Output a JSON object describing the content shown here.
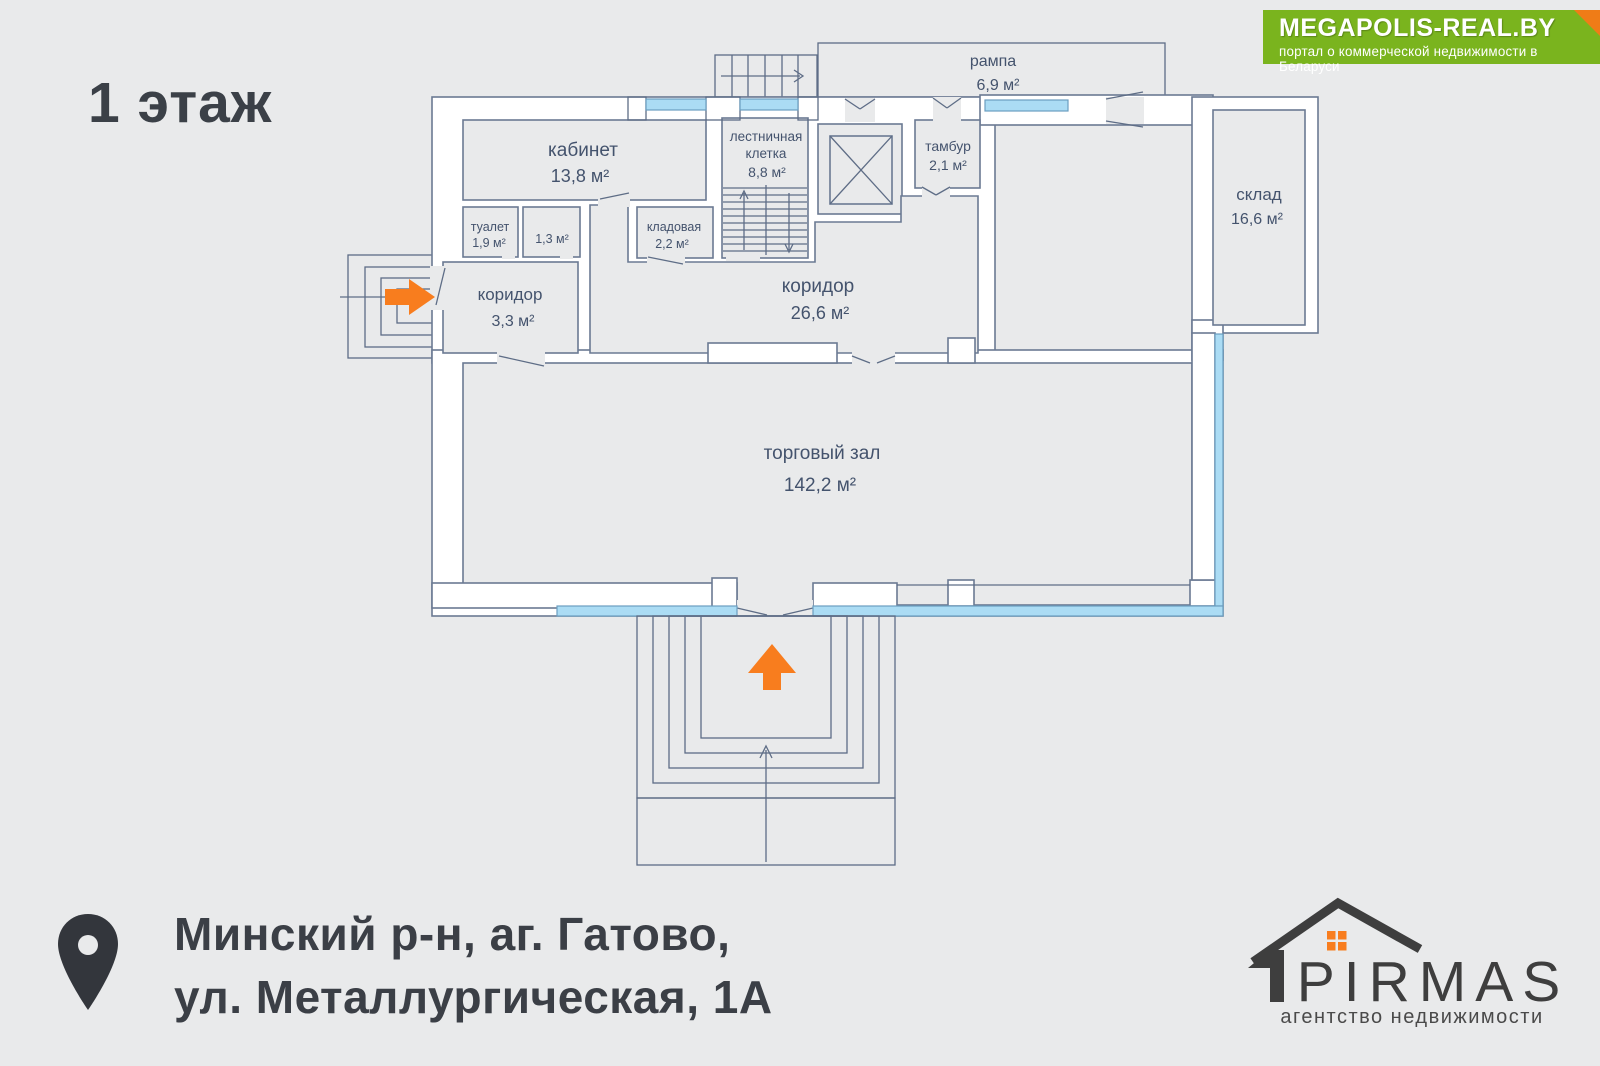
{
  "floor_label": "1 этаж",
  "banner": {
    "title": "MEGAPOLIS-REAL.BY",
    "subtitle": "портал о коммерческой недвижимости в Беларуси",
    "bg_color": "#7ab41e",
    "fold_color": "#ef7c17"
  },
  "address": {
    "line1": "Минский р-н, аг. Гатово,",
    "line2": "ул. Металлургическая, 1А"
  },
  "agency": {
    "name": "PIRMAS",
    "tagline": "агентство недвижимости"
  },
  "plan": {
    "rooms": {
      "kabinet": {
        "name": "кабинет",
        "area": "13,8 м²"
      },
      "tualet": {
        "name": "туалет",
        "area": "1,9 м²"
      },
      "room_1_3": {
        "area": "1,3 м²"
      },
      "kladovaya": {
        "name": "кладовая",
        "area": "2,2 м²"
      },
      "stairwell": {
        "name_line1": "лестничная",
        "name_line2": "клетка",
        "area": "8,8 м²"
      },
      "tambur": {
        "name": "тамбур",
        "area": "2,1 м²"
      },
      "rampa": {
        "name": "рампа",
        "area": "6,9 м²"
      },
      "sklad": {
        "name": "склад",
        "area": "16,6 м²"
      },
      "koridor_small": {
        "name": "коридор",
        "area": "3,3 м²"
      },
      "koridor_big": {
        "name": "коридор",
        "area": "26,6 м²"
      },
      "torgovy_zal": {
        "name": "торговый зал",
        "area": "142,2 м²"
      }
    },
    "colors": {
      "wall_stroke": "#6b7a93",
      "window_fill": "#abdcf4",
      "entrance_arrow": "#f87d1e",
      "label_text": "#44536d"
    }
  }
}
